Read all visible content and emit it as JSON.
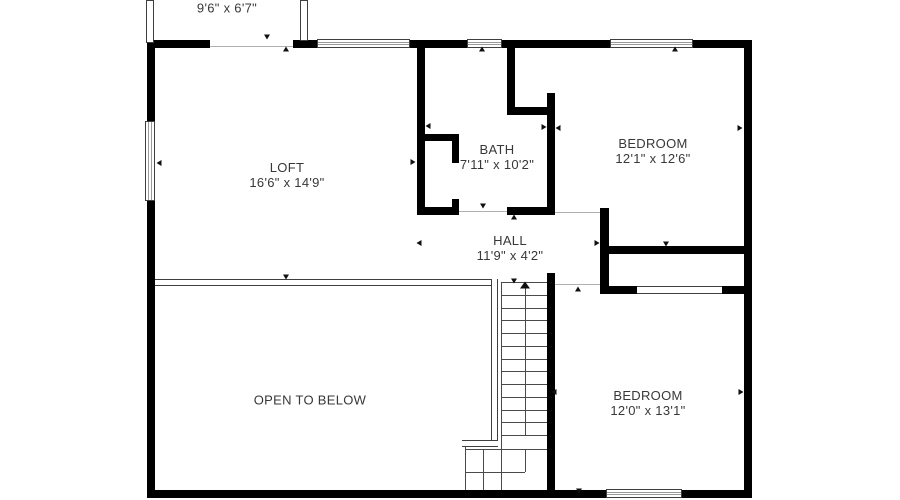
{
  "rooms": {
    "balcony": {
      "dims": "9'6\" x 6'7\""
    },
    "loft": {
      "name": "LOFT",
      "dims": "16'6\" x 14'9\""
    },
    "bath": {
      "name": "BATH",
      "dims": "7'11\" x 10'2\""
    },
    "bedroom1": {
      "name": "BEDROOM",
      "dims": "12'1\" x 12'6\""
    },
    "hall": {
      "name": "HALL",
      "dims": "11'9\" x 4'2\""
    },
    "open_to_below": {
      "name": "OPEN TO BELOW"
    },
    "bedroom2": {
      "name": "BEDROOM",
      "dims": "12'0\" x 13'1\""
    }
  },
  "plan": {
    "wall_color": "#000000",
    "line_color": "#4a4a4a",
    "text_color": "#383838",
    "walls": [
      [
        147,
        40,
        63,
        8
      ],
      [
        293,
        40,
        24,
        8
      ],
      [
        410,
        40,
        57,
        8
      ],
      [
        502,
        40,
        108,
        8
      ],
      [
        693,
        40,
        59,
        8
      ],
      [
        147,
        40,
        8,
        81
      ],
      [
        147,
        201,
        8,
        297
      ],
      [
        744,
        40,
        8,
        458
      ],
      [
        147,
        490,
        459,
        8
      ],
      [
        682,
        490,
        70,
        8
      ],
      [
        417,
        48,
        8,
        167
      ],
      [
        507,
        48,
        8,
        67
      ],
      [
        507,
        107,
        48,
        8
      ],
      [
        547,
        93,
        8,
        122
      ],
      [
        547,
        273,
        8,
        225
      ],
      [
        417,
        207,
        42,
        8
      ],
      [
        507,
        207,
        48,
        8
      ],
      [
        419,
        134,
        40,
        7
      ],
      [
        452,
        134,
        7,
        29
      ],
      [
        452,
        199,
        7,
        16
      ],
      [
        600,
        208,
        9,
        86
      ],
      [
        607,
        246,
        137,
        8
      ],
      [
        600,
        286,
        37,
        8
      ],
      [
        722,
        286,
        22,
        8
      ]
    ],
    "balcony_walls": [
      [
        146,
        0,
        8,
        43
      ],
      [
        300,
        0,
        8,
        41
      ]
    ],
    "windows": [
      [
        317,
        39,
        93,
        9,
        "h"
      ],
      [
        467,
        39,
        35,
        9,
        "h"
      ],
      [
        610,
        39,
        83,
        9,
        "h"
      ],
      [
        145,
        121,
        10,
        80,
        "v"
      ],
      [
        606,
        489,
        76,
        9,
        "h"
      ]
    ],
    "railings": [
      [
        155,
        279,
        343,
        7,
        "h"
      ],
      [
        491,
        279,
        7,
        168,
        "v"
      ],
      [
        462,
        440,
        36,
        7,
        "h"
      ],
      [
        637,
        286,
        85,
        8,
        "h"
      ]
    ],
    "lines": [
      [
        501,
        282,
        1,
        208
      ],
      [
        501,
        282,
        46,
        1
      ],
      [
        501,
        295,
        46,
        1
      ],
      [
        501,
        308,
        46,
        1
      ],
      [
        501,
        320,
        46,
        1
      ],
      [
        501,
        333,
        46,
        1
      ],
      [
        501,
        346,
        46,
        1
      ],
      [
        501,
        359,
        46,
        1
      ],
      [
        501,
        371,
        46,
        1
      ],
      [
        501,
        384,
        46,
        1
      ],
      [
        501,
        397,
        46,
        1
      ],
      [
        501,
        410,
        46,
        1
      ],
      [
        501,
        422,
        46,
        1
      ],
      [
        501,
        435,
        46,
        1
      ],
      [
        466,
        449,
        81,
        1
      ],
      [
        466,
        472,
        59,
        1
      ],
      [
        483,
        449,
        1,
        41
      ],
      [
        525,
        449,
        1,
        23
      ],
      [
        465,
        447,
        1,
        43
      ],
      [
        525,
        288,
        1,
        147
      ]
    ],
    "thresholds": [
      [
        210,
        46,
        83,
        1
      ],
      [
        459,
        211,
        48,
        1
      ],
      [
        555,
        212,
        45,
        1
      ],
      [
        555,
        284,
        45,
        1
      ]
    ],
    "markers": [
      {
        "x": 267,
        "y": 37,
        "d": "down"
      },
      {
        "x": 286,
        "y": 49,
        "d": "up"
      },
      {
        "x": 482,
        "y": 49,
        "d": "up"
      },
      {
        "x": 675,
        "y": 49,
        "d": "up"
      },
      {
        "x": 159,
        "y": 163,
        "d": "left"
      },
      {
        "x": 413,
        "y": 162,
        "d": "right"
      },
      {
        "x": 428,
        "y": 126,
        "d": "left"
      },
      {
        "x": 544,
        "y": 127,
        "d": "right"
      },
      {
        "x": 558,
        "y": 128,
        "d": "left"
      },
      {
        "x": 740,
        "y": 128,
        "d": "right"
      },
      {
        "x": 483,
        "y": 206,
        "d": "down"
      },
      {
        "x": 514,
        "y": 217,
        "d": "up"
      },
      {
        "x": 419,
        "y": 243,
        "d": "left"
      },
      {
        "x": 597,
        "y": 243,
        "d": "right"
      },
      {
        "x": 666,
        "y": 244,
        "d": "down"
      },
      {
        "x": 286,
        "y": 277,
        "d": "down"
      },
      {
        "x": 514,
        "y": 281,
        "d": "down"
      },
      {
        "x": 578,
        "y": 289,
        "d": "up"
      },
      {
        "x": 554,
        "y": 392,
        "d": "left"
      },
      {
        "x": 741,
        "y": 392,
        "d": "right"
      },
      {
        "x": 579,
        "y": 491,
        "d": "down"
      }
    ],
    "stair_arrow": {
      "x": 525,
      "y": 285,
      "d": "up"
    }
  }
}
